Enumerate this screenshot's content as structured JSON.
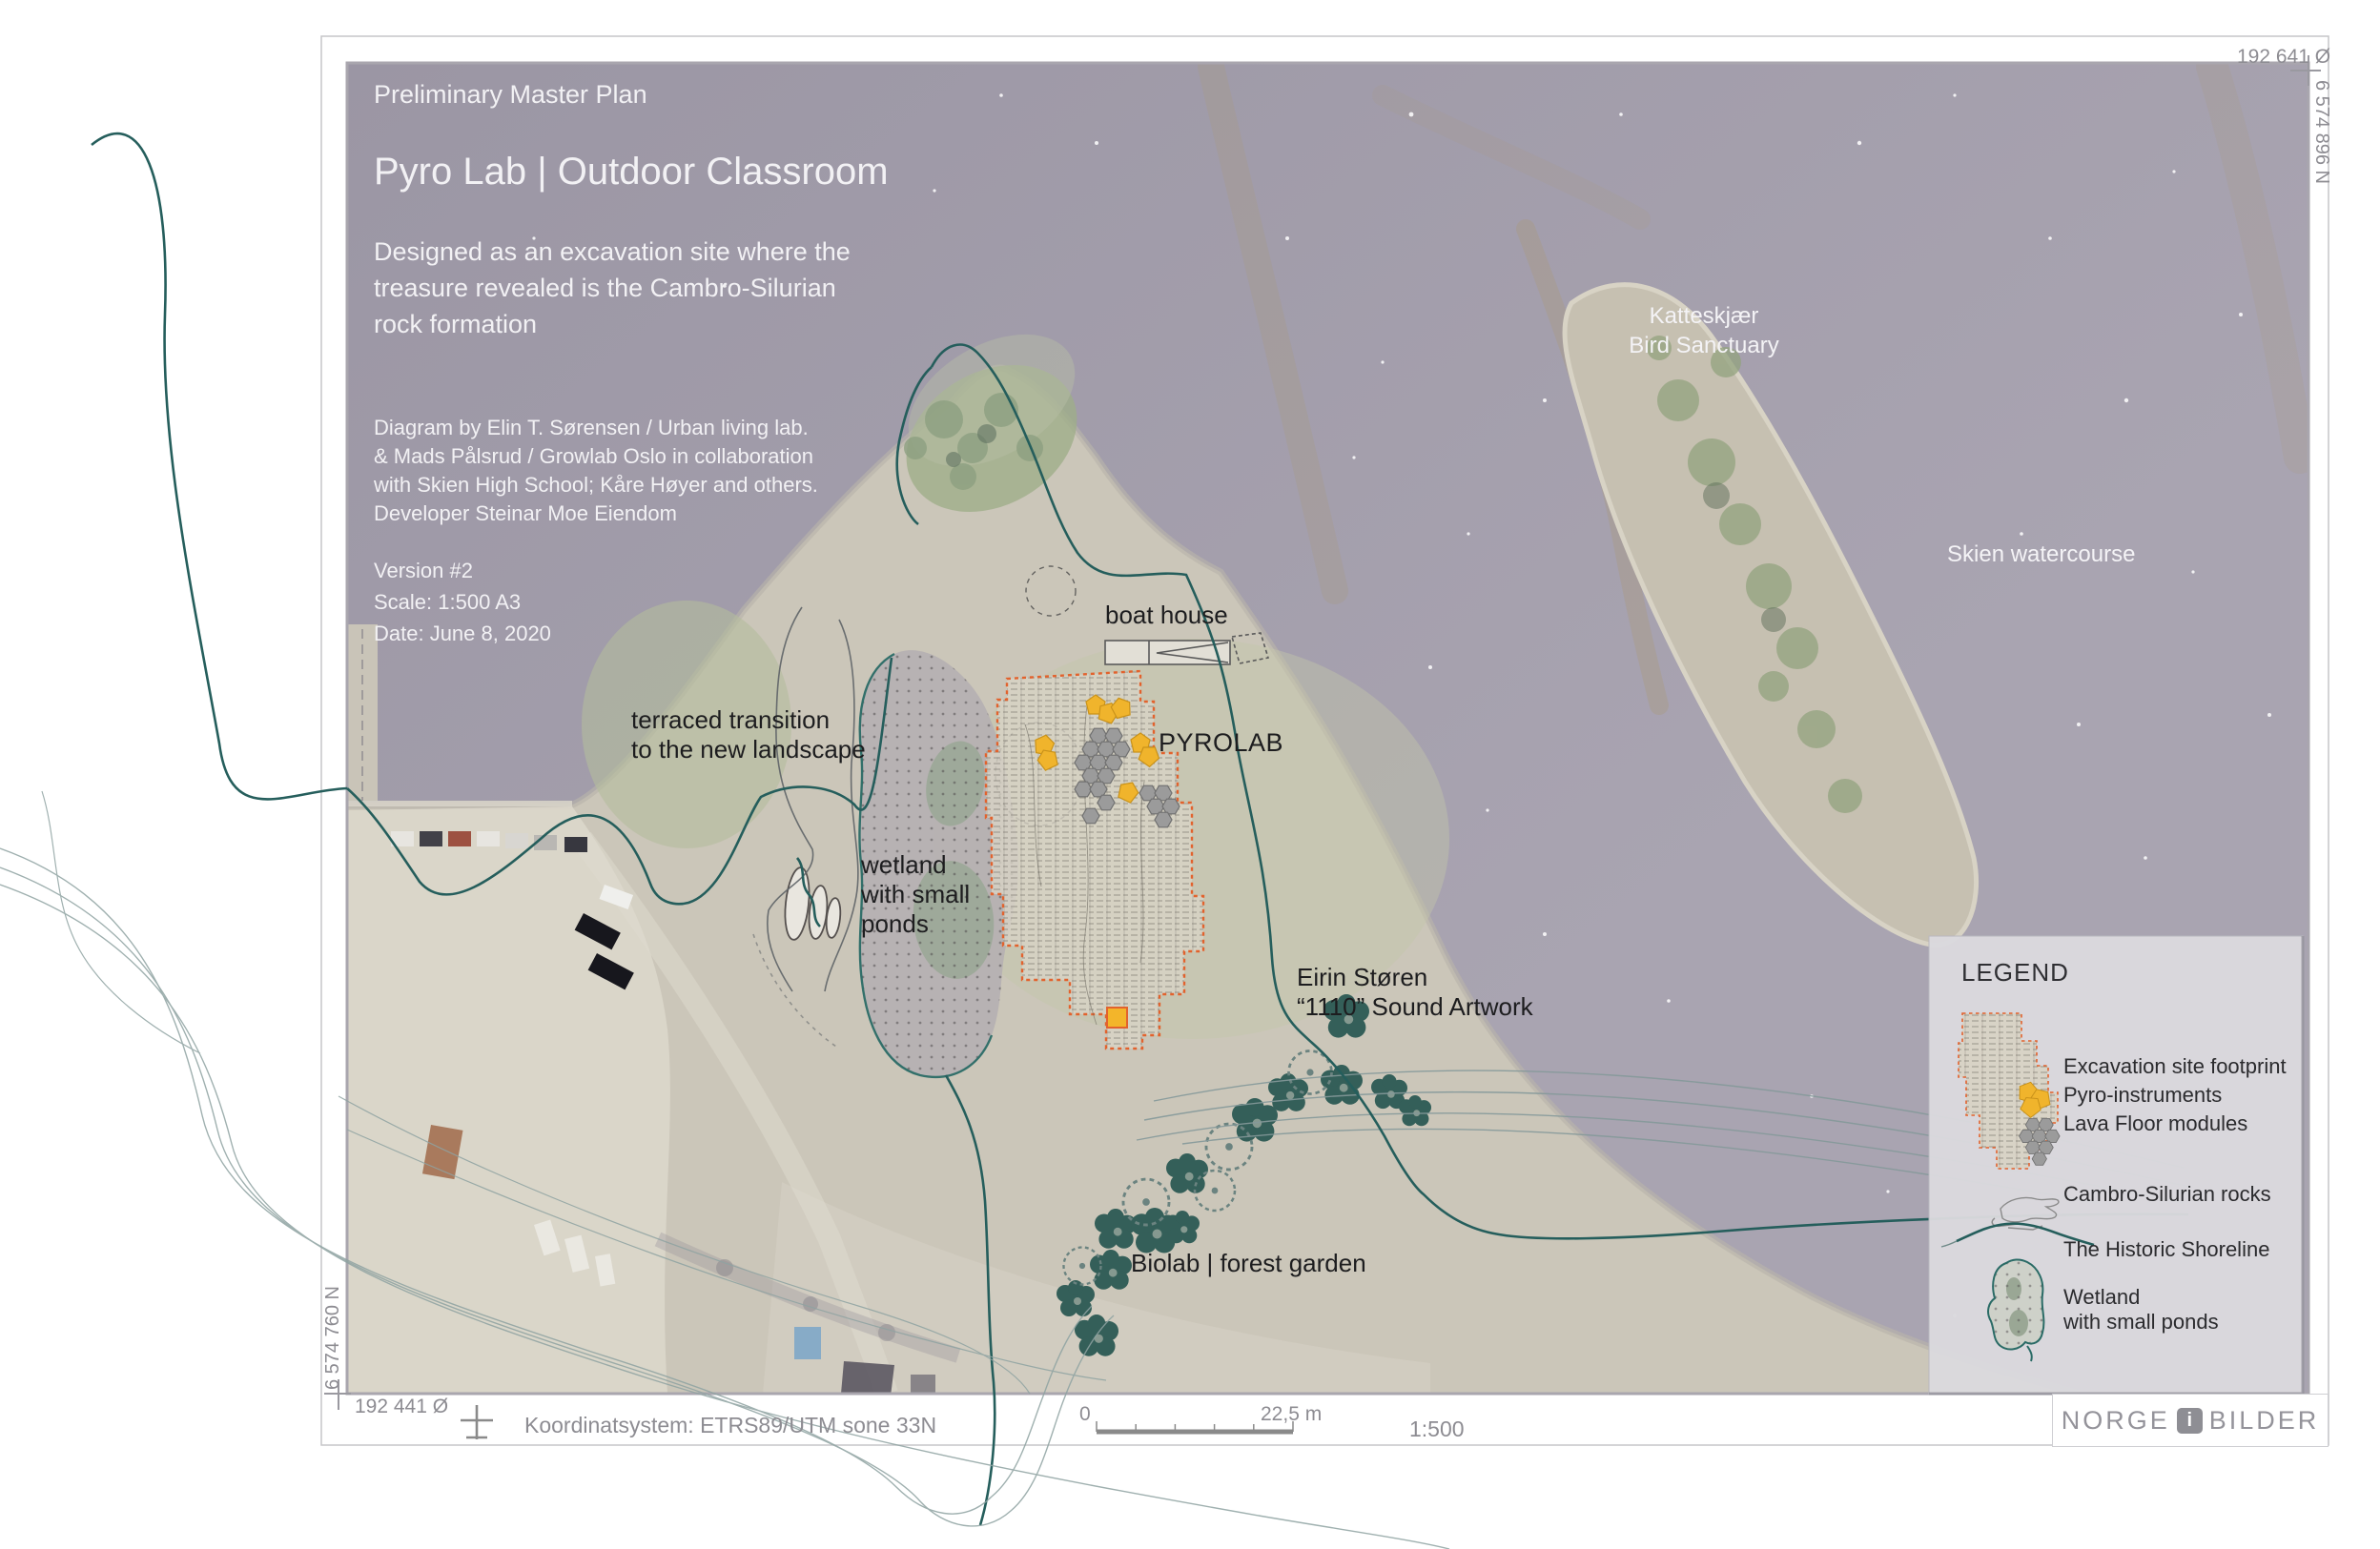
{
  "header": {
    "kicker": "Preliminary Master Plan",
    "title": "Pyro Lab | Outdoor Classroom",
    "description_lines": [
      "Designed as an excavation site where the",
      "treasure revealed is the Cambro-Silurian",
      "rock formation"
    ],
    "credit_lines": [
      "Diagram by Elin T. Sørensen / Urban living lab.",
      "& Mads Pålsrud / Growlab Oslo in collaboration",
      "with Skien High School; Kåre Høyer and others.",
      "Developer Steinar Moe Eiendom"
    ],
    "version_lines": [
      "Version #2",
      "Scale: 1:500 A3",
      "Date: June 8, 2020"
    ]
  },
  "map_labels": {
    "bird_sanctuary_line1": "Katteskjær",
    "bird_sanctuary_line2": "Bird Sanctuary",
    "watercourse": "Skien watercourse",
    "boat_house": "boat house",
    "pyrolab": "PYROLAB",
    "terraced_line1": "terraced transition",
    "terraced_line2": "to the new landscape",
    "wetland_line1": "wetland",
    "wetland_line2": "with small",
    "wetland_line3": "ponds",
    "sound_artwork_line1": "Eirin Støren",
    "sound_artwork_line2": "“1110” Sound Artwork",
    "biolab": "Biolab | forest garden"
  },
  "legend": {
    "title": "LEGEND",
    "excavation": "Excavation site footprint",
    "pyro": "Pyro-instruments",
    "lava": "Lava Floor modules",
    "rocks": "Cambro-Silurian rocks",
    "shoreline": "The Historic Shoreline",
    "wetland_line1": "Wetland",
    "wetland_line2": "with small ponds"
  },
  "footer": {
    "coord_bottom_left": "192 441 Ø",
    "coord_top_right": "192 641 Ø",
    "coord_right_vertical": "6 574 896 N",
    "coord_left_vertical": "6 574 760 N",
    "coordinate_system": "Koordinatsystem: ETRS89/UTM sone 33N",
    "scale_zero": "0",
    "scale_distance": "22,5 m",
    "scale_ratio": "1:500",
    "logo_part1": "NORGE",
    "logo_part2": "i",
    "logo_part3": "BILDER"
  },
  "colors": {
    "historic_shoreline_teal": "#255e5c",
    "excavation_orange": "#e2622d",
    "pyro_yellow": "#f0b42c",
    "lava_gray": "#9b9b9b",
    "water": "#a6a1ae",
    "land": "#cbc6b9"
  }
}
